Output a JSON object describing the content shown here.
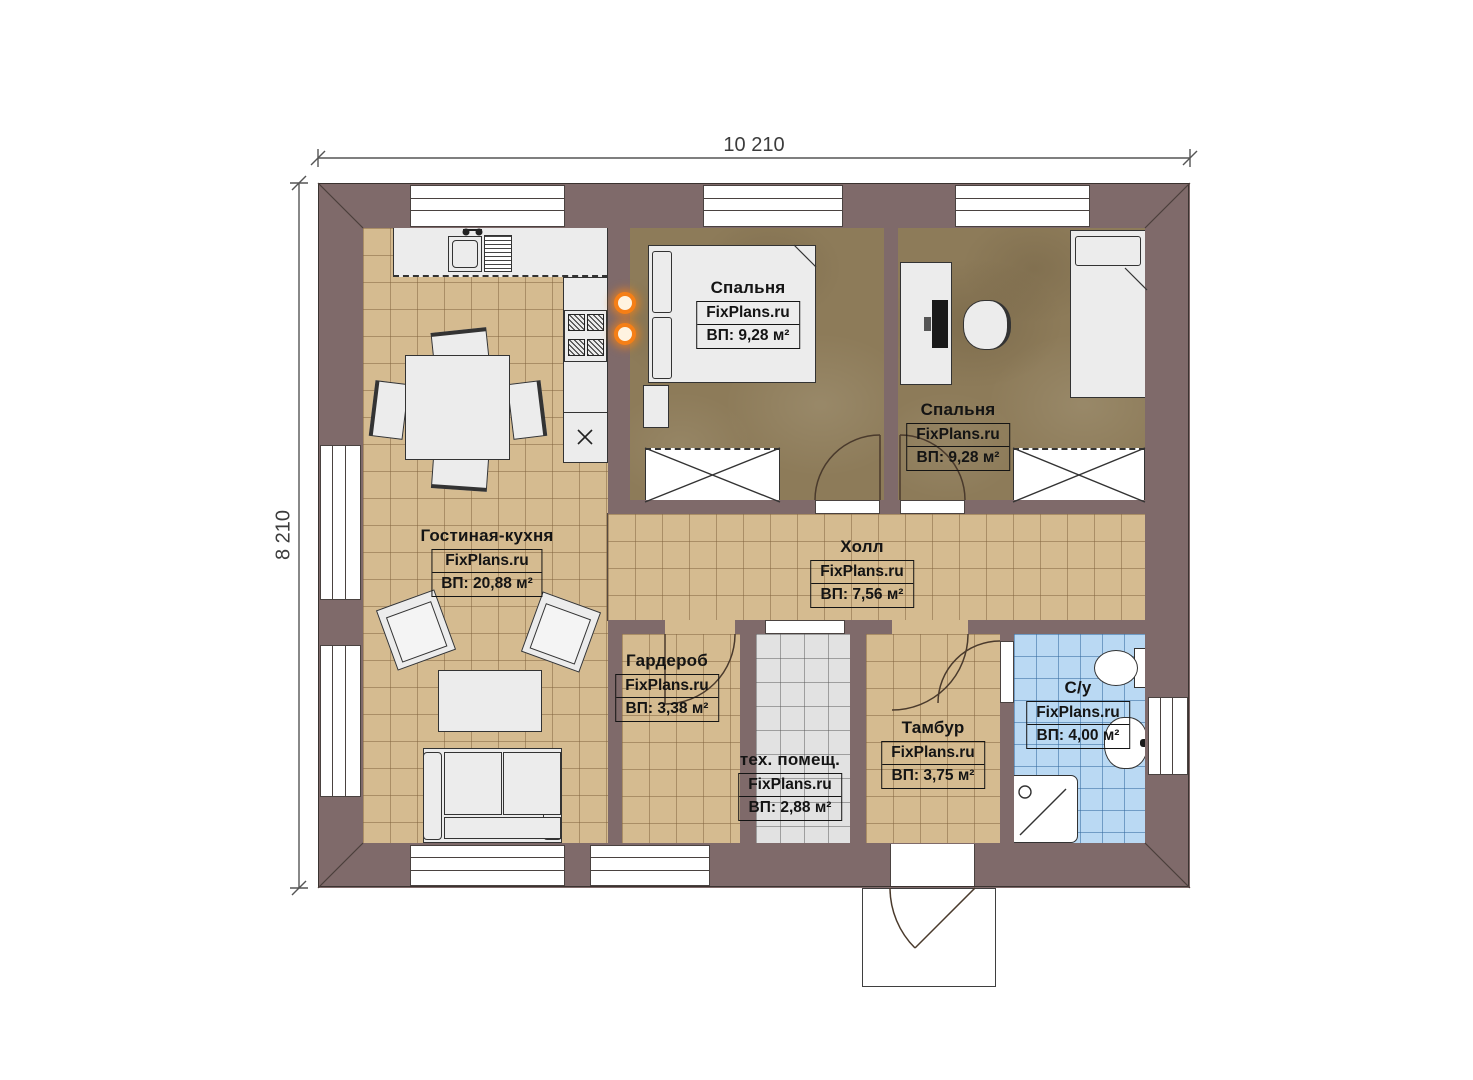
{
  "dimensions": {
    "width_mm": "10 210",
    "height_mm": "8 210"
  },
  "watermark": "FixPlans.ru",
  "rooms": {
    "living": {
      "name": "Гостиная-кухня",
      "brand": "FixPlans.ru",
      "area": "ВП: 20,88 м²"
    },
    "bedroom1": {
      "name": "Спальня",
      "brand": "FixPlans.ru",
      "area": "ВП: 9,28 м²"
    },
    "bedroom2": {
      "name": "Спальня",
      "brand": "FixPlans.ru",
      "area": "ВП: 9,28 м²"
    },
    "hall": {
      "name": "Холл",
      "brand": "FixPlans.ru",
      "area": "ВП: 7,56 м²"
    },
    "wardrobe": {
      "name": "Гардероб",
      "brand": "FixPlans.ru",
      "area": "ВП: 3,38 м²"
    },
    "tech": {
      "name": "тех. помещ.",
      "brand": "FixPlans.ru",
      "area": "ВП: 2,88 м²"
    },
    "tambour": {
      "name": "Тамбур",
      "brand": "FixPlans.ru",
      "area": "ВП: 3,75 м²"
    },
    "bathroom": {
      "name": "С/у",
      "brand": "FixPlans.ru",
      "area": "ВП: 4,00 м²"
    }
  },
  "colors": {
    "wall": "#7f6a6a",
    "tile_floor": "#d5bb90",
    "bedroom_floor": "#8d7b59",
    "bathroom_floor": "#bad9f3",
    "tech_floor": "#e2e2e2",
    "furniture": "#ececec",
    "linework": "#3a3330",
    "sconce_accent": "#f57f17"
  }
}
